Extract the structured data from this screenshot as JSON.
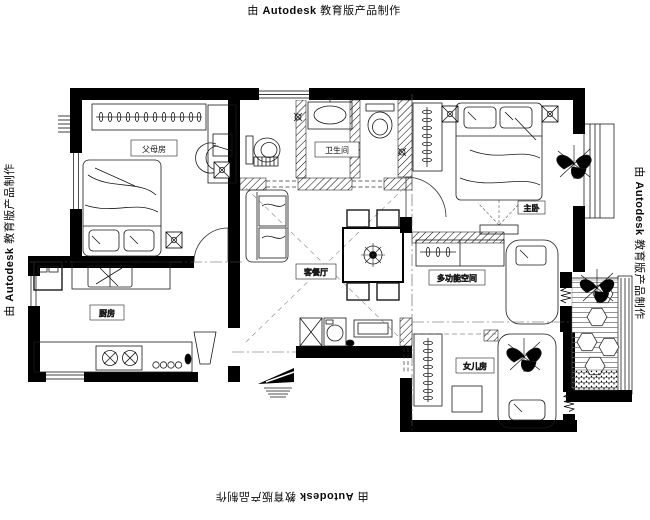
{
  "watermark": {
    "prefix": "由",
    "brand": "Autodesk",
    "suffix": "教育版产品制作"
  },
  "rooms": {
    "parents": {
      "label": "父母房"
    },
    "bathroom": {
      "label": "卫生间"
    },
    "master": {
      "label": "主卧"
    },
    "living_dining": {
      "label": "客餐厅"
    },
    "multipurpose": {
      "label": "多功能空间"
    },
    "kitchen": {
      "label": "厨房"
    },
    "daughter": {
      "label": "女儿房"
    }
  },
  "colors": {
    "walls": "#000000",
    "lines": "#1a1a1a",
    "background": "#ffffff"
  }
}
